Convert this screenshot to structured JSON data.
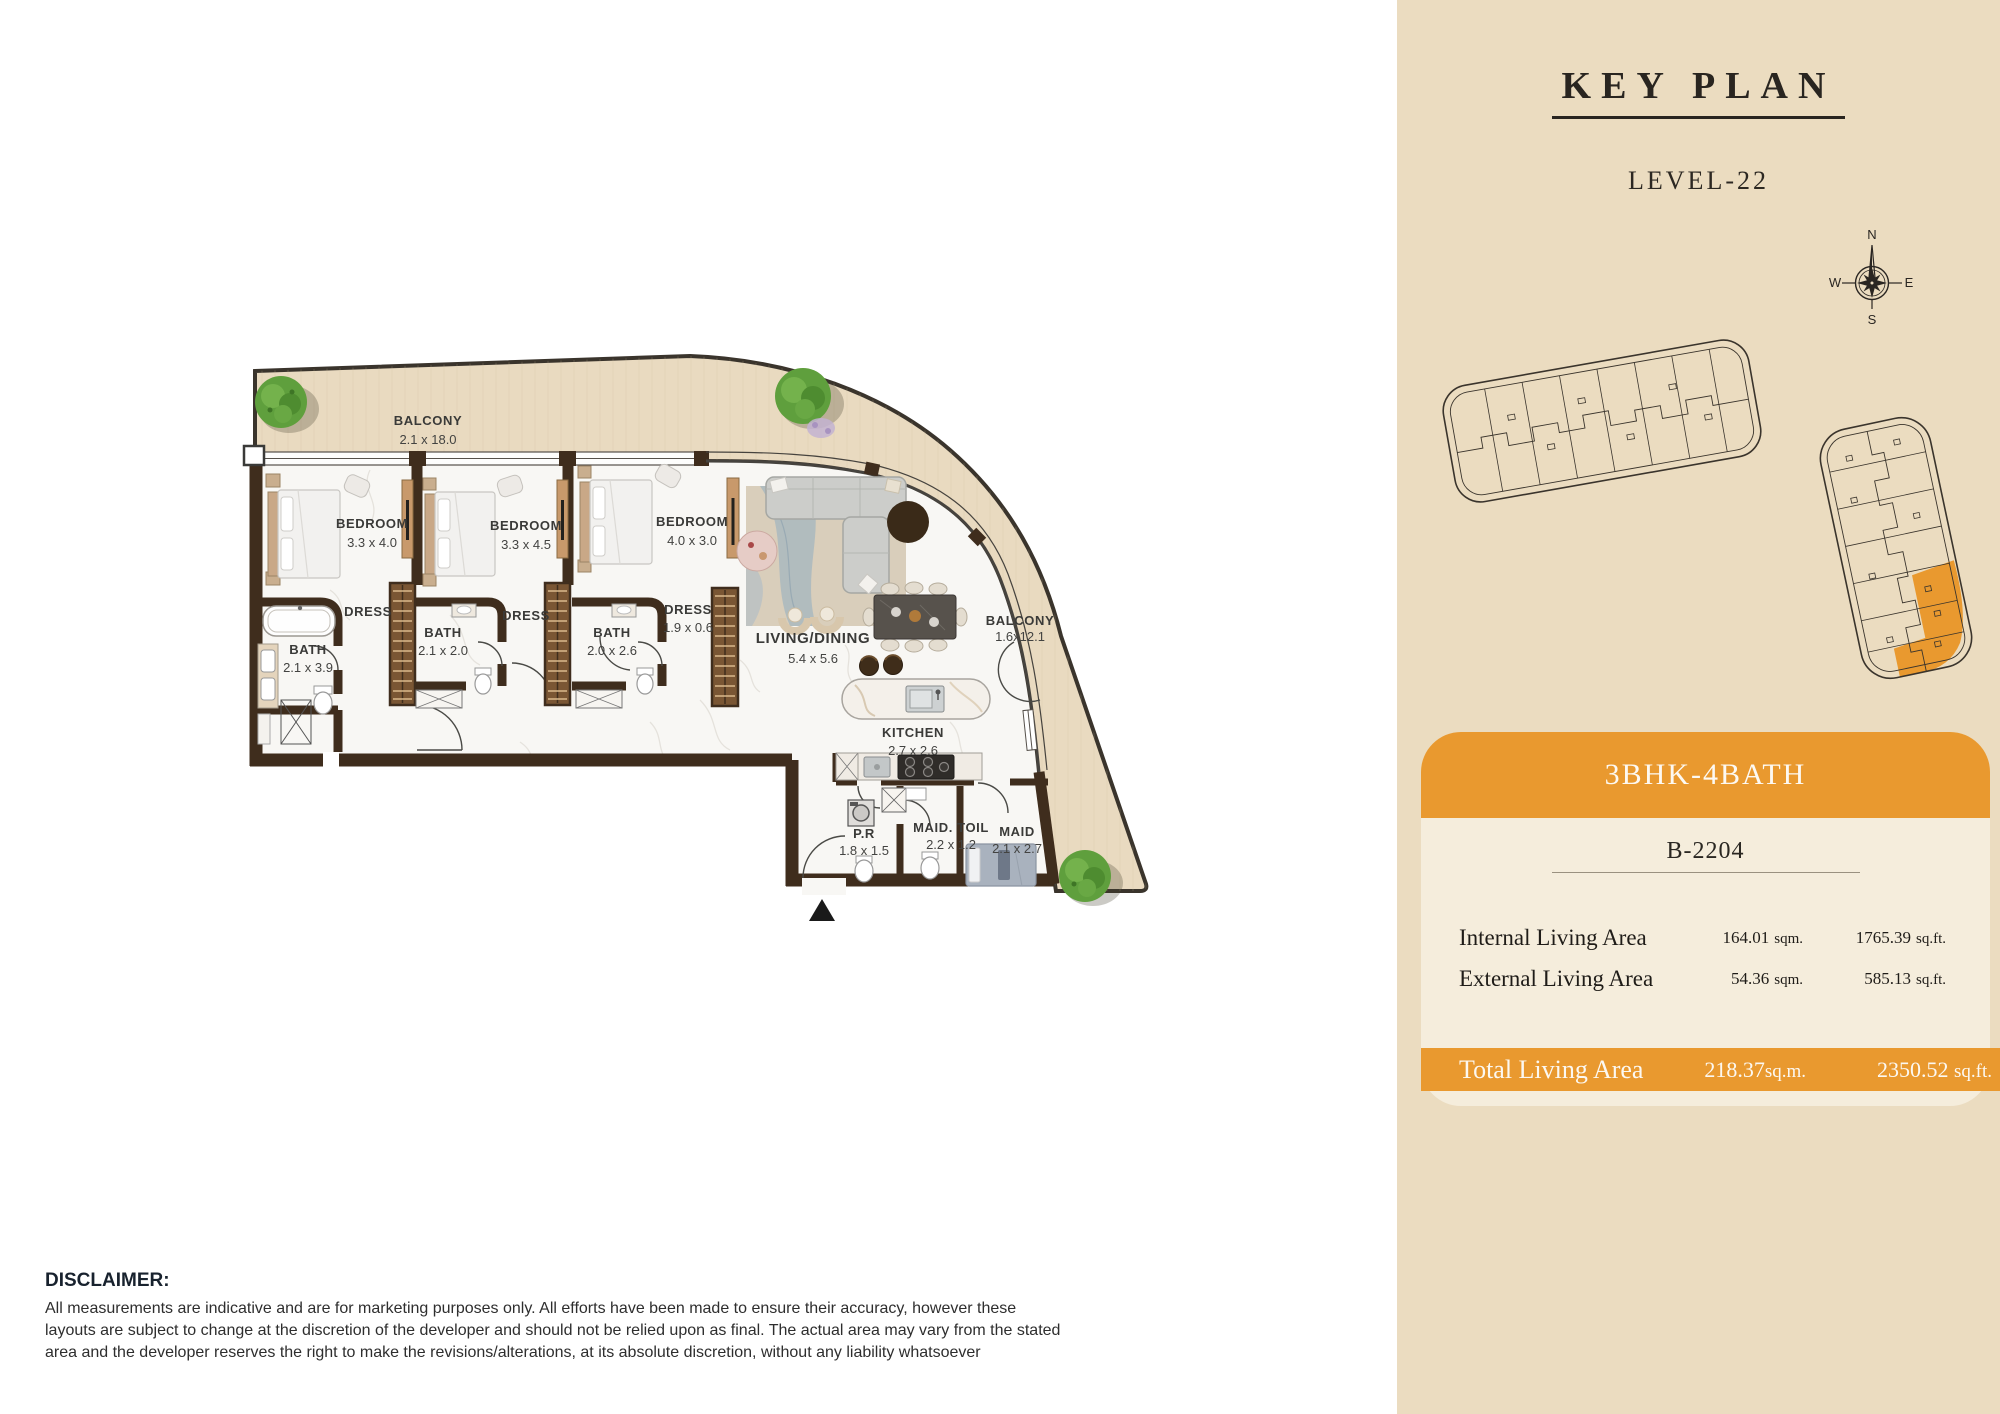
{
  "key_plan": {
    "title": "KEY PLAN",
    "level": "LEVEL-22",
    "compass": {
      "north": "N",
      "south": "S",
      "east": "E",
      "west": "W"
    }
  },
  "floor_plan": {
    "rooms": [
      {
        "name": "BALCONY",
        "dims": "2.1 x 18.0"
      },
      {
        "name": "BEDROOM",
        "dims": "3.3 x 4.0"
      },
      {
        "name": "BEDROOM",
        "dims": "3.3 x 4.5"
      },
      {
        "name": "BEDROOM",
        "dims": "4.0 x 3.0"
      },
      {
        "name": "DRESS",
        "dims": ""
      },
      {
        "name": "BATH",
        "dims": "2.1 x 3.9"
      },
      {
        "name": "BATH",
        "dims": "2.1 x 2.0"
      },
      {
        "name": "DRESS",
        "dims": ""
      },
      {
        "name": "BATH",
        "dims": "2.0 x 2.6"
      },
      {
        "name": "DRESS",
        "dims": "1.9 x 0.6"
      },
      {
        "name": "LIVING/DINING",
        "dims": "5.4 x 5.6"
      },
      {
        "name": "BALCONY",
        "dims": "1.6x12.1"
      },
      {
        "name": "KITCHEN",
        "dims": "2.7 x 2.6"
      },
      {
        "name": "P.R",
        "dims": "1.8 x 1.5"
      },
      {
        "name": "MAID. TOIL",
        "dims": "2.2 x 1.2"
      },
      {
        "name": "MAID",
        "dims": "2.1 x 2.7"
      }
    ],
    "icons": {
      "entrance_marker": "triangle-up",
      "compass": "compass-rose",
      "trees": "plan-tree"
    }
  },
  "unit_card": {
    "type": "3BHK-4BATH",
    "unit_number": "B-2204",
    "rows": [
      {
        "label": "Internal Living Area",
        "sqm": "164.01",
        "sqm_unit": "sqm.",
        "sqft": "1765.39",
        "sqft_unit": "sq.ft."
      },
      {
        "label": "External Living Area",
        "sqm": "54.36",
        "sqm_unit": "sqm.",
        "sqft": "585.13",
        "sqft_unit": "sq.ft."
      }
    ],
    "total": {
      "label": "Total Living Area",
      "sqm": "218.37",
      "sqm_unit": "sq.m.",
      "sqft": "2350.52",
      "sqft_unit": "sq.ft."
    }
  },
  "disclaimer": {
    "title": "DISCLAIMER:",
    "body": "All measurements are indicative and are for marketing purposes only. All efforts have been made to ensure their accuracy, however these layouts are subject to change at the discretion of the developer and should not be relied upon as final. The actual area may vary from the stated area and the developer reserves the right to make the revisions/alterations, at its absolute discretion, without any liability whatsoever"
  },
  "colors": {
    "accent_orange": "#E9992F",
    "panel_beige": "#EBDCC0",
    "card_cream": "#F5EDDC",
    "wall_brown": "#3F2D1D",
    "balcony_wood": "#E9DAC0",
    "highlighted_unit": "#E9992F"
  }
}
